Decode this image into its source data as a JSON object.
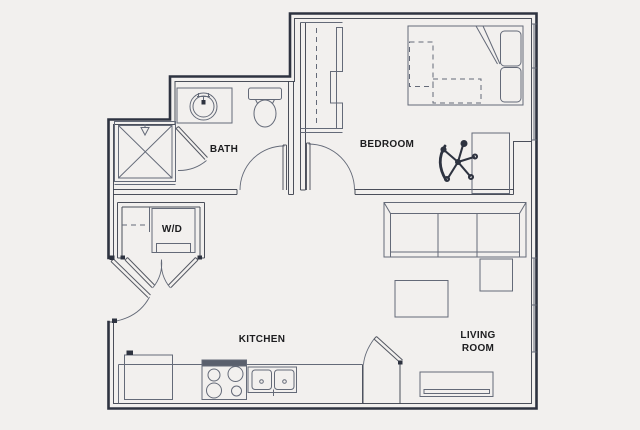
{
  "labels": {
    "bath": "BATH",
    "bedroom": "BEDROOM",
    "washer_dryer": "W/D",
    "kitchen": "KITCHEN",
    "living_line1": "LIVING",
    "living_line2": "ROOM"
  },
  "colors": {
    "background": "#f2f0ee",
    "wall": "#2e3340",
    "line": "#646a78",
    "text": "#1d1d1f"
  }
}
